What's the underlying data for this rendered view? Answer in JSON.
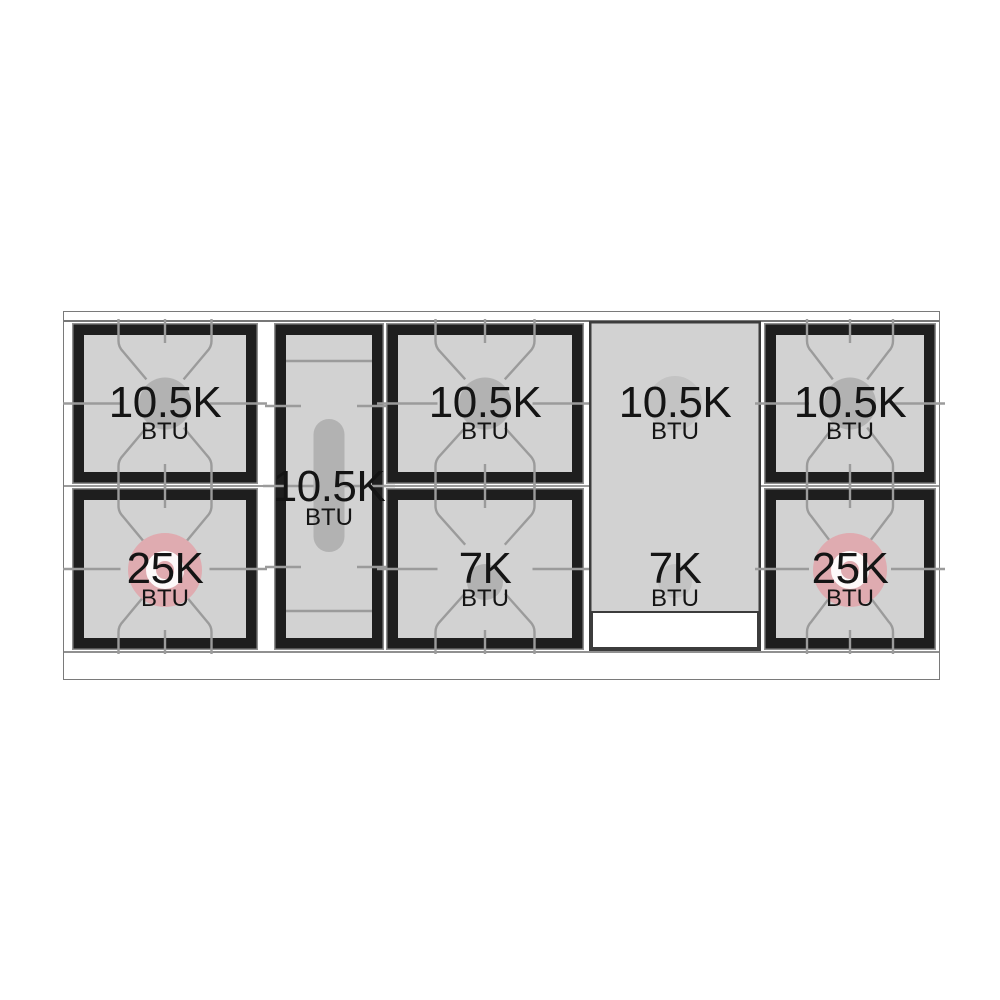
{
  "unit_label": "BTU",
  "colors": {
    "grate_black": "#1e1e1e",
    "panel_gray": "#d2d2d2",
    "line_gray": "#9b9b9b",
    "burner_gray": "#b2b2b2",
    "high_power_pink": "#dfabb0",
    "griddle_gray": "#d2d2d2",
    "griddle_circle_gray": "#c3c3c3",
    "griddle_border": "#3c3c3c",
    "text_color": "#141414"
  },
  "sections": [
    {
      "name": "left-burner-pair",
      "burners": [
        {
          "btu": "10.5K",
          "unit": "BTU"
        },
        {
          "btu": "25K",
          "unit": "BTU"
        }
      ]
    },
    {
      "name": "center-left-oval-burner",
      "burners": [
        {
          "btu": "10.5K",
          "unit": "BTU"
        }
      ]
    },
    {
      "name": "middle-burner-pair",
      "burners": [
        {
          "btu": "10.5K",
          "unit": "BTU"
        },
        {
          "btu": "7K",
          "unit": "BTU"
        }
      ]
    },
    {
      "name": "griddle",
      "burners": [
        {
          "btu": "10.5K",
          "unit": "BTU"
        },
        {
          "btu": "7K",
          "unit": "BTU"
        }
      ]
    },
    {
      "name": "right-burner-pair",
      "burners": [
        {
          "btu": "10.5K",
          "unit": "BTU"
        },
        {
          "btu": "25K",
          "unit": "BTU"
        }
      ]
    }
  ]
}
